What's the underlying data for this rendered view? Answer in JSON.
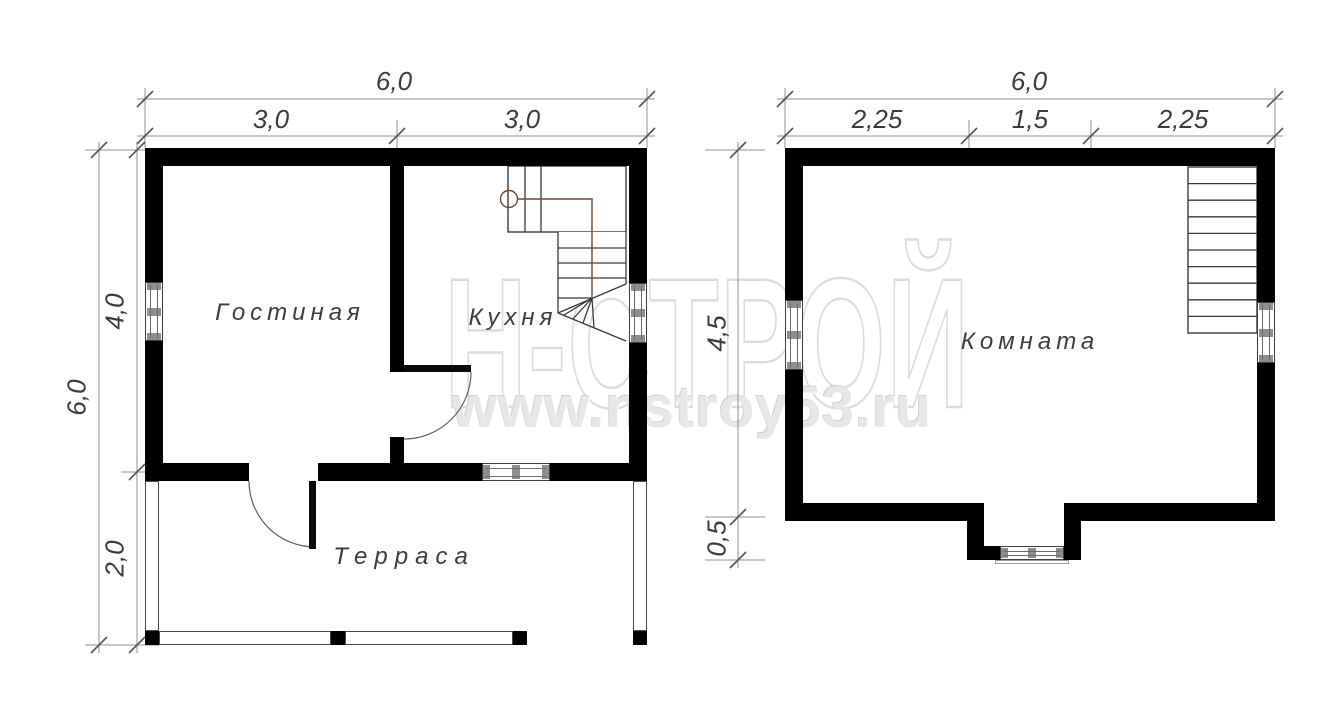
{
  "watermark": {
    "brand": "Н-СТРОЙ",
    "url": "www.nstroy53.ru"
  },
  "floor1": {
    "rooms": {
      "living": "Гостиная",
      "kitchen": "Кухня",
      "terrace": "Терраса"
    },
    "dims": {
      "top_total": "6,0",
      "top_seg1": "3,0",
      "top_seg2": "3,0",
      "left_total": "6,0",
      "left_seg1": "4,0",
      "left_seg2": "2,0"
    }
  },
  "floor2": {
    "rooms": {
      "room": "Комната"
    },
    "dims": {
      "top_total": "6,0",
      "top_seg1": "2,25",
      "top_seg2": "1,5",
      "top_seg3": "2,25",
      "left_seg1": "4,5",
      "left_seg2": "0,5"
    }
  },
  "colors": {
    "wall": "#000000",
    "dim_line": "#909090",
    "tick": "#575757",
    "label": "#3d3d3d",
    "stair_line": "#3a3a3a",
    "stair_route": "#6b4a33",
    "window_mark": "#8e8e8e",
    "watermark": "#dcdcdc"
  }
}
